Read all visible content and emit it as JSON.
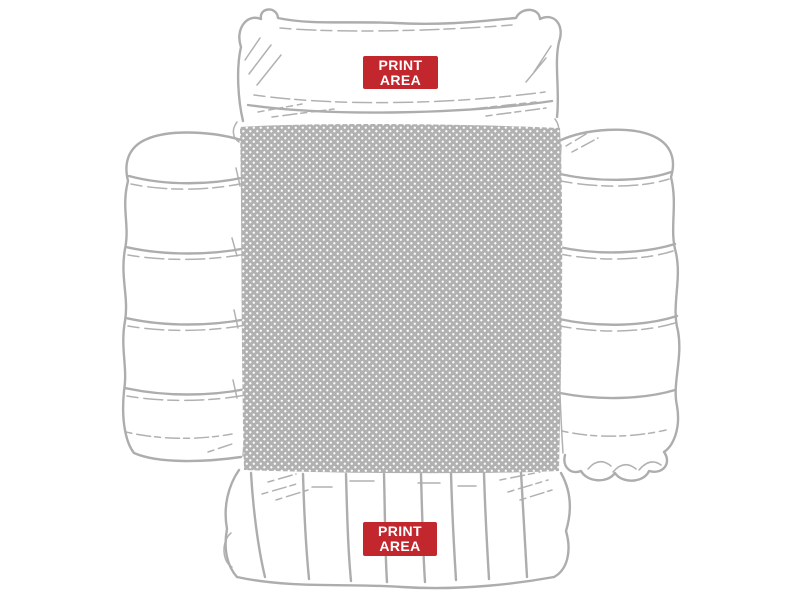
{
  "page": {
    "background": "#ffffff"
  },
  "illustration": {
    "name": "puffer-jacket-flat-lay-sketch",
    "line_color": "#adadad"
  },
  "print_zone": {
    "fill_color": "#b1b1b1",
    "dot_color": "#ffffff"
  },
  "labels": {
    "background": "#c1272d",
    "text_color": "#ffffff",
    "top": {
      "line1": "PRINT",
      "line2": "AREA"
    },
    "bottom": {
      "line1": "PRINT",
      "line2": "AREA"
    }
  }
}
